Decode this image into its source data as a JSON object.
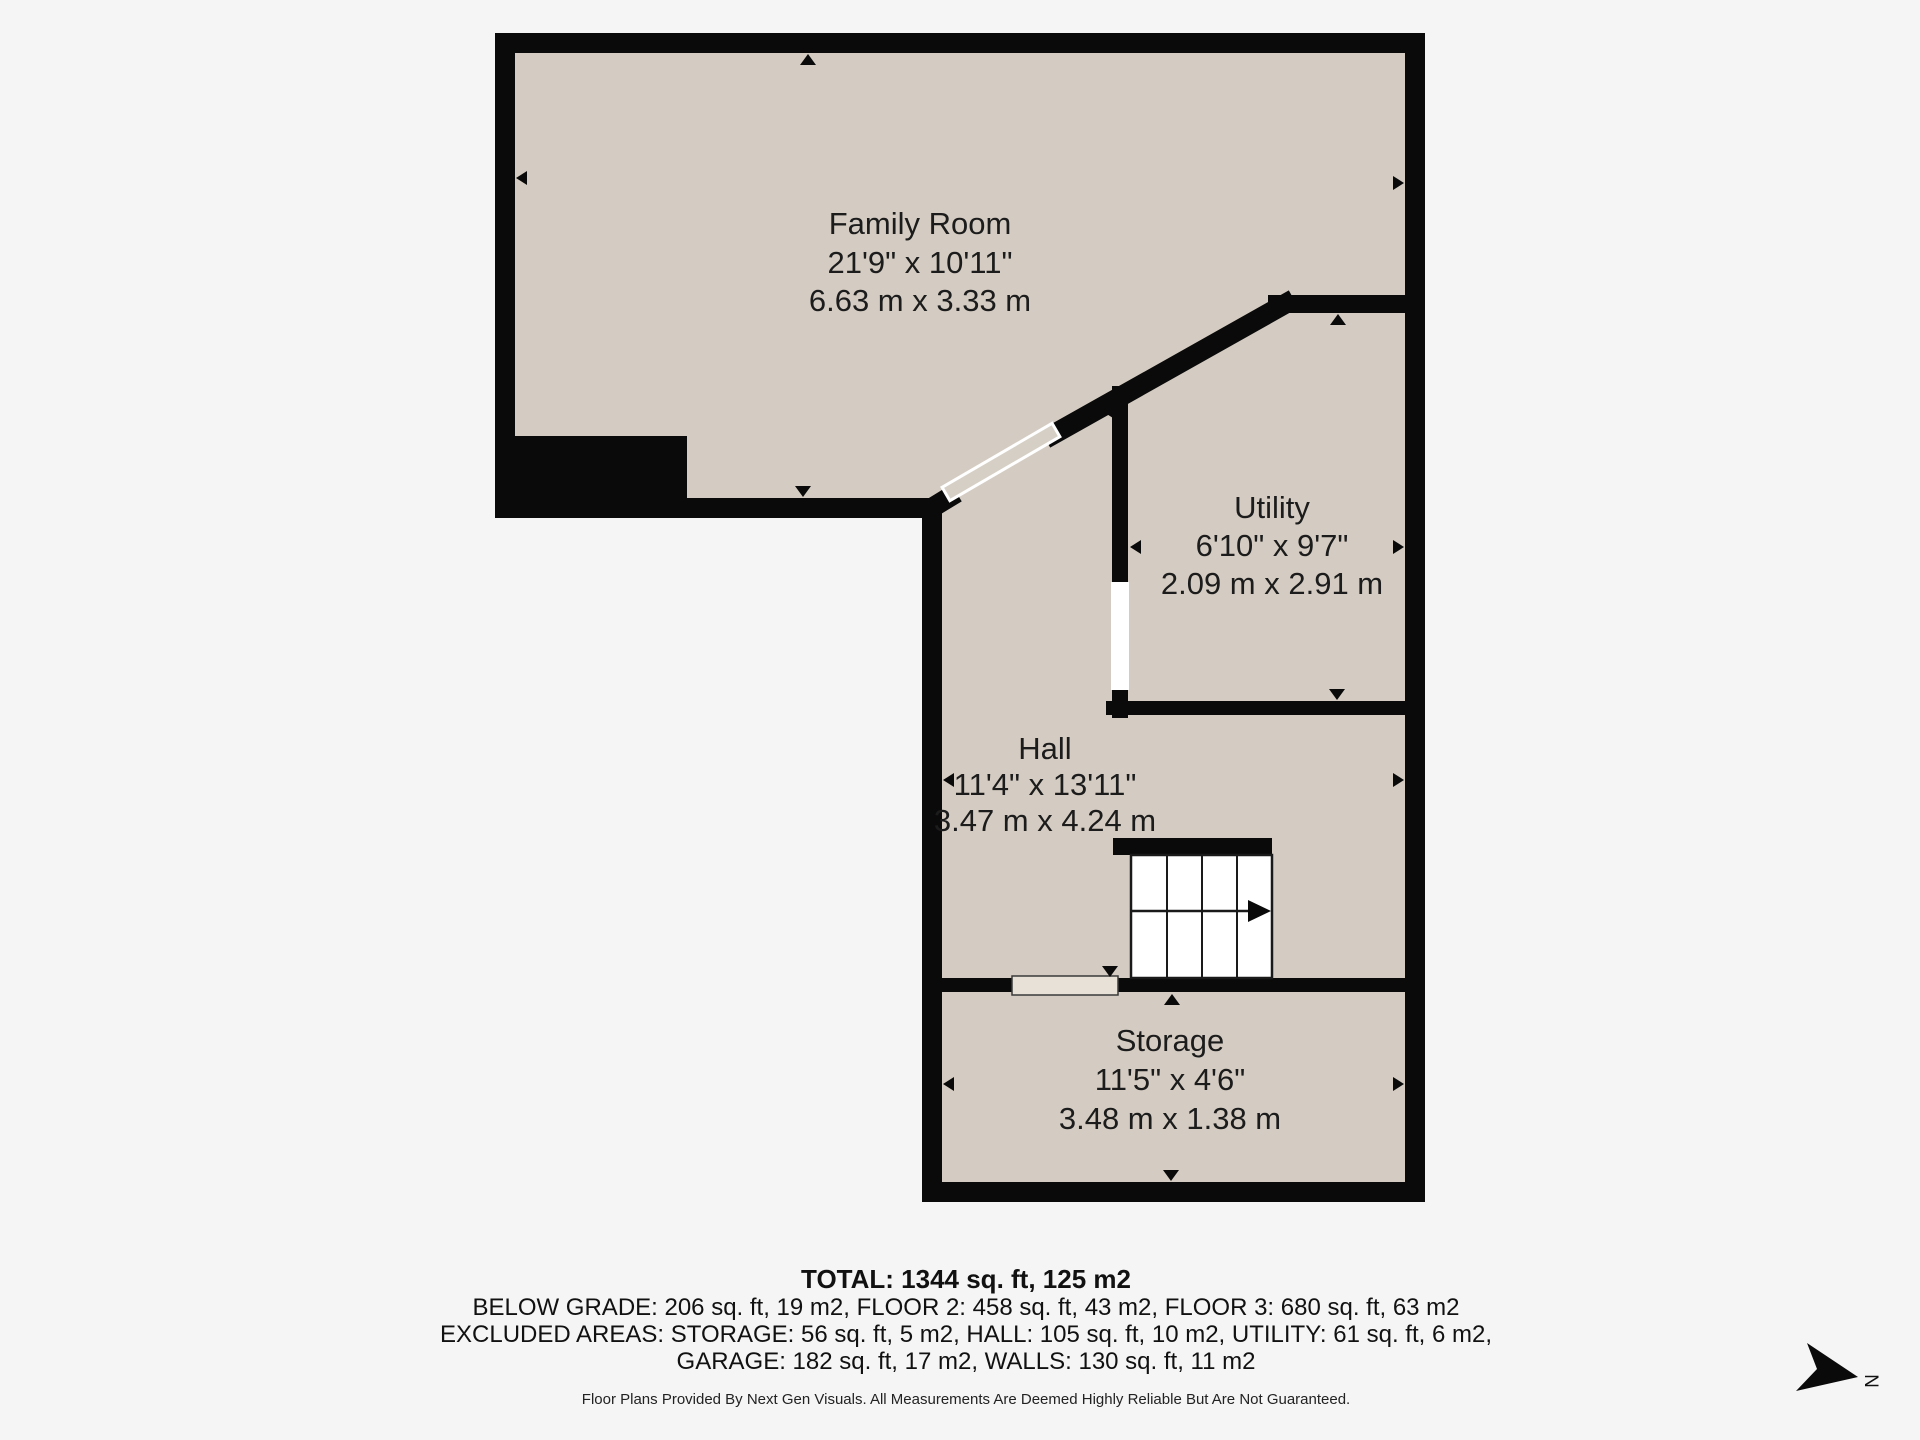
{
  "rooms": [
    {
      "id": "family-room",
      "name": "Family Room",
      "imperial": "21'9\" x 10'11\"",
      "metric": "6.63 m x 3.33 m"
    },
    {
      "id": "utility",
      "name": "Utility",
      "imperial": "6'10\" x 9'7\"",
      "metric": "2.09 m x 2.91 m"
    },
    {
      "id": "hall",
      "name": "Hall",
      "imperial": "11'4\" x 13'11\"",
      "metric": "3.47 m x 4.24 m"
    },
    {
      "id": "storage",
      "name": "Storage",
      "imperial": "11'5\" x 4'6\"",
      "metric": "3.48 m x 1.38 m"
    }
  ],
  "summary": {
    "total": "TOTAL: 1344 sq. ft, 125 m2",
    "line2": "BELOW GRADE: 206 sq. ft, 19 m2, FLOOR 2: 458 sq. ft, 43 m2, FLOOR 3: 680 sq. ft, 63 m2",
    "line3": "EXCLUDED AREAS: STORAGE: 56 sq. ft, 5 m2, HALL: 105 sq. ft, 10 m2, UTILITY: 61 sq. ft, 6 m2,",
    "line4": "GARAGE: 182 sq. ft, 17 m2, WALLS: 130 sq. ft, 11 m2",
    "disclaimer": "Floor Plans Provided By Next Gen Visuals. All Measurements Are Deemed Highly Reliable But Are Not Guaranteed."
  },
  "compass": {
    "label": "N"
  },
  "colors": {
    "page_background": "#f5f5f5",
    "wall": "#0a0a0a",
    "floor": "#d4ccc2",
    "door_slab": "#e7e1d7",
    "stairs": "#ffffff",
    "label_text": "#1c1c1c"
  }
}
